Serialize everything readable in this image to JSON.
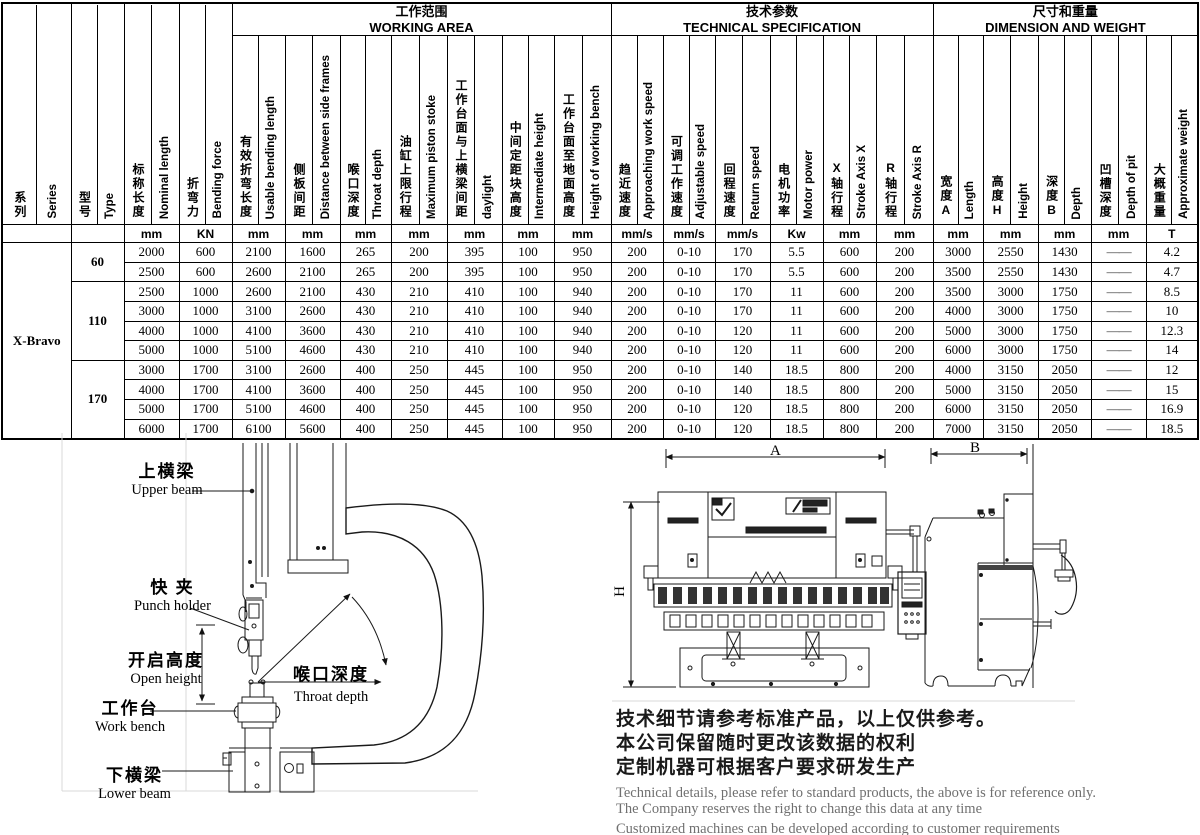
{
  "table": {
    "groups": [
      {
        "cn": "工作范围",
        "en": "WORKING AREA",
        "span": 7
      },
      {
        "cn": "技术参数",
        "en": "TECHNICAL SPECIFICATION",
        "span": 6
      },
      {
        "cn": "尺寸和重量",
        "en": "DIMENSION AND WEIGHT",
        "span": 5
      }
    ],
    "columns": [
      {
        "cn": "系列",
        "en": "Series",
        "unit": ""
      },
      {
        "cn": "型号",
        "en": "Type",
        "unit": ""
      },
      {
        "cn": "标称长度",
        "en": "Nominal length",
        "unit": "mm"
      },
      {
        "cn": "折弯力",
        "en": "Bending force",
        "unit": "KN"
      },
      {
        "cn": "有效折弯长度",
        "en": "Usable bending length",
        "unit": "mm"
      },
      {
        "cn": "侧板间距",
        "en": "Distance between side frames",
        "unit": "mm"
      },
      {
        "cn": "喉口深度",
        "en": "Throat depth",
        "unit": "mm"
      },
      {
        "cn": "油缸上限行程",
        "en": "Maximum piston stoke",
        "unit": "mm"
      },
      {
        "cn": "工作台面与上横梁间距",
        "en": "daylight",
        "unit": "mm"
      },
      {
        "cn": "中间定距块高度",
        "en": "Intermediate height",
        "unit": "mm"
      },
      {
        "cn": "工作台面至地面高度",
        "en": "Height of working bench",
        "unit": "mm"
      },
      {
        "cn": "趋近速度",
        "en": "Approaching work speed",
        "unit": "mm/s"
      },
      {
        "cn": "可调工作速度",
        "en": "Adjustable speed",
        "unit": "mm/s"
      },
      {
        "cn": "回程速度",
        "en": "Return speed",
        "unit": "mm/s"
      },
      {
        "cn": "电机功率",
        "en": "Motor power",
        "unit": "Kw"
      },
      {
        "cn": "X轴行程",
        "en": "Stroke Axis X",
        "unit": "mm"
      },
      {
        "cn": "R轴行程",
        "en": "Stroke Axis R",
        "unit": "mm"
      },
      {
        "cn": "宽度A",
        "en": "Length",
        "unit": "mm"
      },
      {
        "cn": "高度H",
        "en": "Height",
        "unit": "mm"
      },
      {
        "cn": "深度B",
        "en": "Depth",
        "unit": "mm"
      },
      {
        "cn": "凹槽深度",
        "en": "Depth of pit",
        "unit": "mm"
      },
      {
        "cn": "大概重量",
        "en": "Approximate weight",
        "unit": "T"
      }
    ],
    "series": "X-Bravo",
    "type_groups": [
      {
        "type": "60",
        "rows": 2
      },
      {
        "type": "110",
        "rows": 4
      },
      {
        "type": "170",
        "rows": 4
      }
    ],
    "rows": [
      [
        "2000",
        "600",
        "2100",
        "1600",
        "265",
        "200",
        "395",
        "100",
        "950",
        "200",
        "0-10",
        "170",
        "5.5",
        "600",
        "200",
        "3000",
        "2550",
        "1430",
        "——",
        "4.2"
      ],
      [
        "2500",
        "600",
        "2600",
        "2100",
        "265",
        "200",
        "395",
        "100",
        "950",
        "200",
        "0-10",
        "170",
        "5.5",
        "600",
        "200",
        "3500",
        "2550",
        "1430",
        "——",
        "4.7"
      ],
      [
        "2500",
        "1000",
        "2600",
        "2100",
        "430",
        "210",
        "410",
        "100",
        "940",
        "200",
        "0-10",
        "170",
        "11",
        "600",
        "200",
        "3500",
        "3000",
        "1750",
        "——",
        "8.5"
      ],
      [
        "3000",
        "1000",
        "3100",
        "2600",
        "430",
        "210",
        "410",
        "100",
        "940",
        "200",
        "0-10",
        "170",
        "11",
        "600",
        "200",
        "4000",
        "3000",
        "1750",
        "——",
        "10"
      ],
      [
        "4000",
        "1000",
        "4100",
        "3600",
        "430",
        "210",
        "410",
        "100",
        "940",
        "200",
        "0-10",
        "120",
        "11",
        "600",
        "200",
        "5000",
        "3000",
        "1750",
        "——",
        "12.3"
      ],
      [
        "5000",
        "1000",
        "5100",
        "4600",
        "430",
        "210",
        "410",
        "100",
        "940",
        "200",
        "0-10",
        "120",
        "11",
        "600",
        "200",
        "6000",
        "3000",
        "1750",
        "——",
        "14"
      ],
      [
        "3000",
        "1700",
        "3100",
        "2600",
        "400",
        "250",
        "445",
        "100",
        "950",
        "200",
        "0-10",
        "140",
        "18.5",
        "800",
        "200",
        "4000",
        "3150",
        "2050",
        "——",
        "12"
      ],
      [
        "4000",
        "1700",
        "4100",
        "3600",
        "400",
        "250",
        "445",
        "100",
        "950",
        "200",
        "0-10",
        "140",
        "18.5",
        "800",
        "200",
        "5000",
        "3150",
        "2050",
        "——",
        "15"
      ],
      [
        "5000",
        "1700",
        "5100",
        "4600",
        "400",
        "250",
        "445",
        "100",
        "950",
        "200",
        "0-10",
        "120",
        "18.5",
        "800",
        "200",
        "6000",
        "3150",
        "2050",
        "——",
        "16.9"
      ],
      [
        "6000",
        "1700",
        "6100",
        "5600",
        "400",
        "250",
        "445",
        "100",
        "950",
        "200",
        "0-10",
        "120",
        "18.5",
        "800",
        "200",
        "7000",
        "3150",
        "2050",
        "——",
        "18.5"
      ]
    ]
  },
  "diagram_labels": {
    "upper_beam": {
      "cn": "上横梁",
      "en": "Upper beam"
    },
    "punch_holder": {
      "cn": "快 夹",
      "en": "Punch holder"
    },
    "open_height": {
      "cn": "开启高度",
      "en": "Open height"
    },
    "throat_depth": {
      "cn": "喉口深度",
      "en": "Throat depth"
    },
    "work_bench": {
      "cn": "工作台",
      "en": "Work bench"
    },
    "lower_beam": {
      "cn": "下横梁",
      "en": "Lower beam"
    }
  },
  "dimension_marks": {
    "width": "A",
    "side_depth": "B",
    "height": "H"
  },
  "notes": {
    "cn_lines": [
      "技术细节请参考标准产品，以上仅供参考。",
      "本公司保留随时更改该数据的权利",
      "定制机器可根据客户要求研发生产"
    ],
    "en_lines": [
      "Technical details, please refer to standard products, the above is for reference only.",
      "The Company reserves the right to change this data at any time",
      "Customized machines can be developed according to customer requirements"
    ]
  },
  "colors": {
    "line": "#1a1a1a",
    "guide": "#d9d9d9",
    "note_en": "#707070"
  }
}
